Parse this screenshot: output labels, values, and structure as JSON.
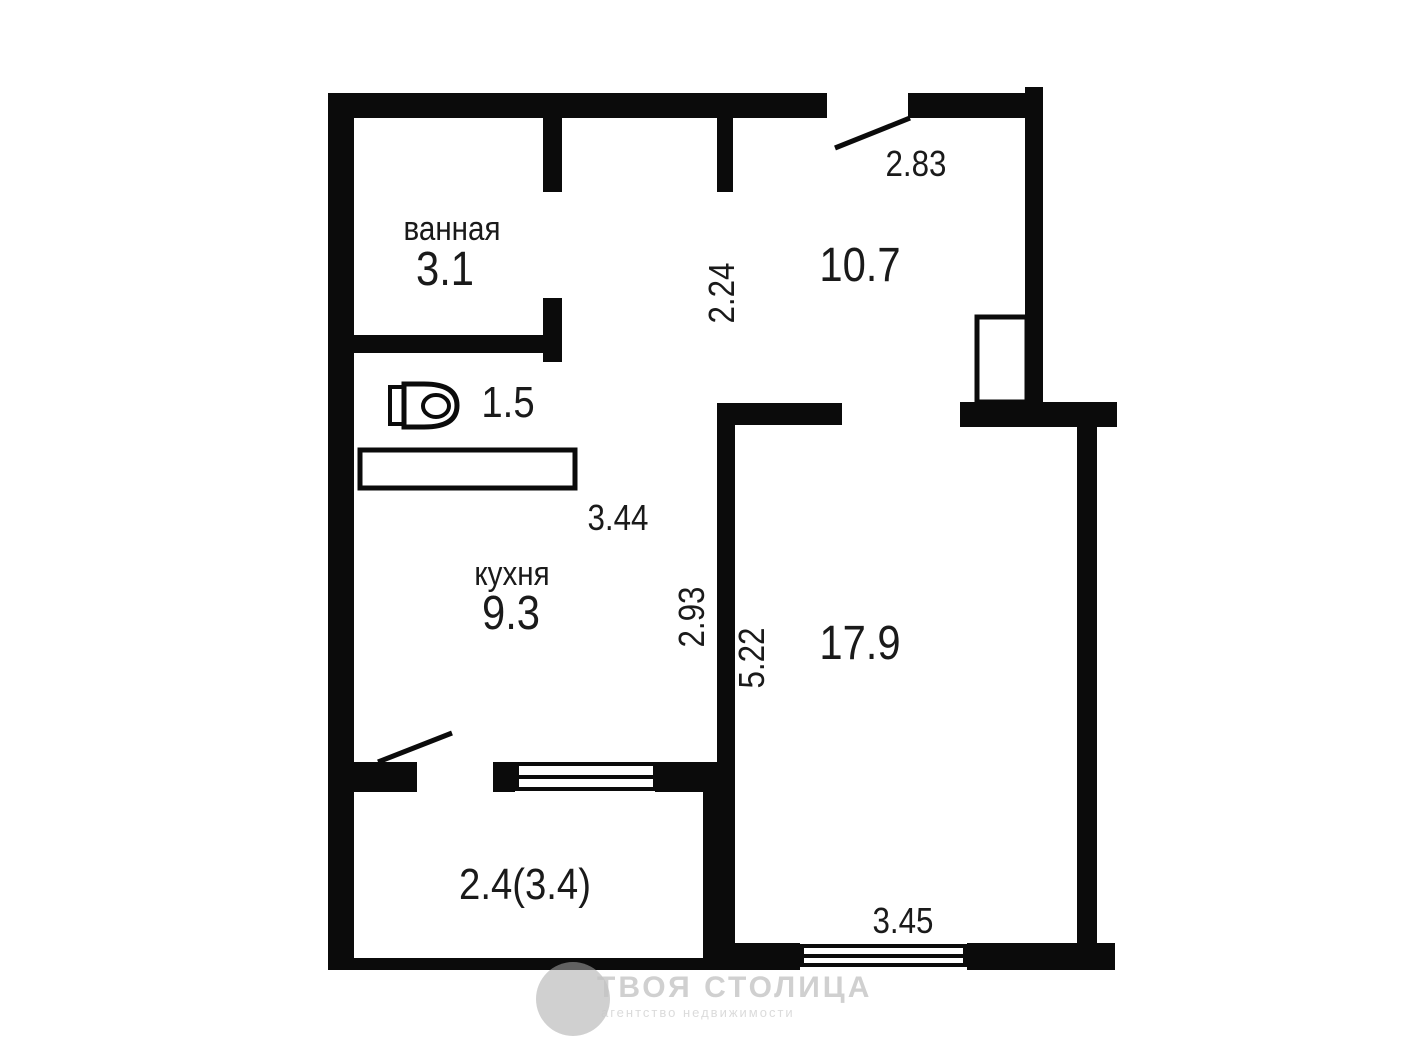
{
  "rooms": {
    "bathroom": {
      "label": "ванная",
      "area": "3.1"
    },
    "wc": {
      "area": "1.5"
    },
    "kitchen": {
      "label": "кухня",
      "area": "9.3"
    },
    "hallway": {
      "area": "10.7"
    },
    "living_room": {
      "area": "17.9"
    },
    "balcony": {
      "area": "2.4(3.4)"
    }
  },
  "dimensions": {
    "entry_width": "2.83",
    "hallway_depth": "2.24",
    "kitchen_width": "3.44",
    "kitchen_depth": "2.93",
    "living_depth": "5.22",
    "living_width": "3.45"
  },
  "watermark": {
    "title": "ТВОЯ СТОЛИЦА",
    "subtitle": "агентство недвижимости"
  },
  "icons": {
    "toilet": "toilet-icon",
    "bathtub": "bathtub-icon",
    "shaft": "ventilation-shaft-icon",
    "entry_door": "door-swing-line",
    "balcony_door": "door-swing-line",
    "window": "double-pane-window"
  },
  "colors": {
    "wall": "#0b0b0b",
    "label_text": "#1a1a1a",
    "watermark": "#c3c3c3",
    "background": "#ffffff"
  }
}
